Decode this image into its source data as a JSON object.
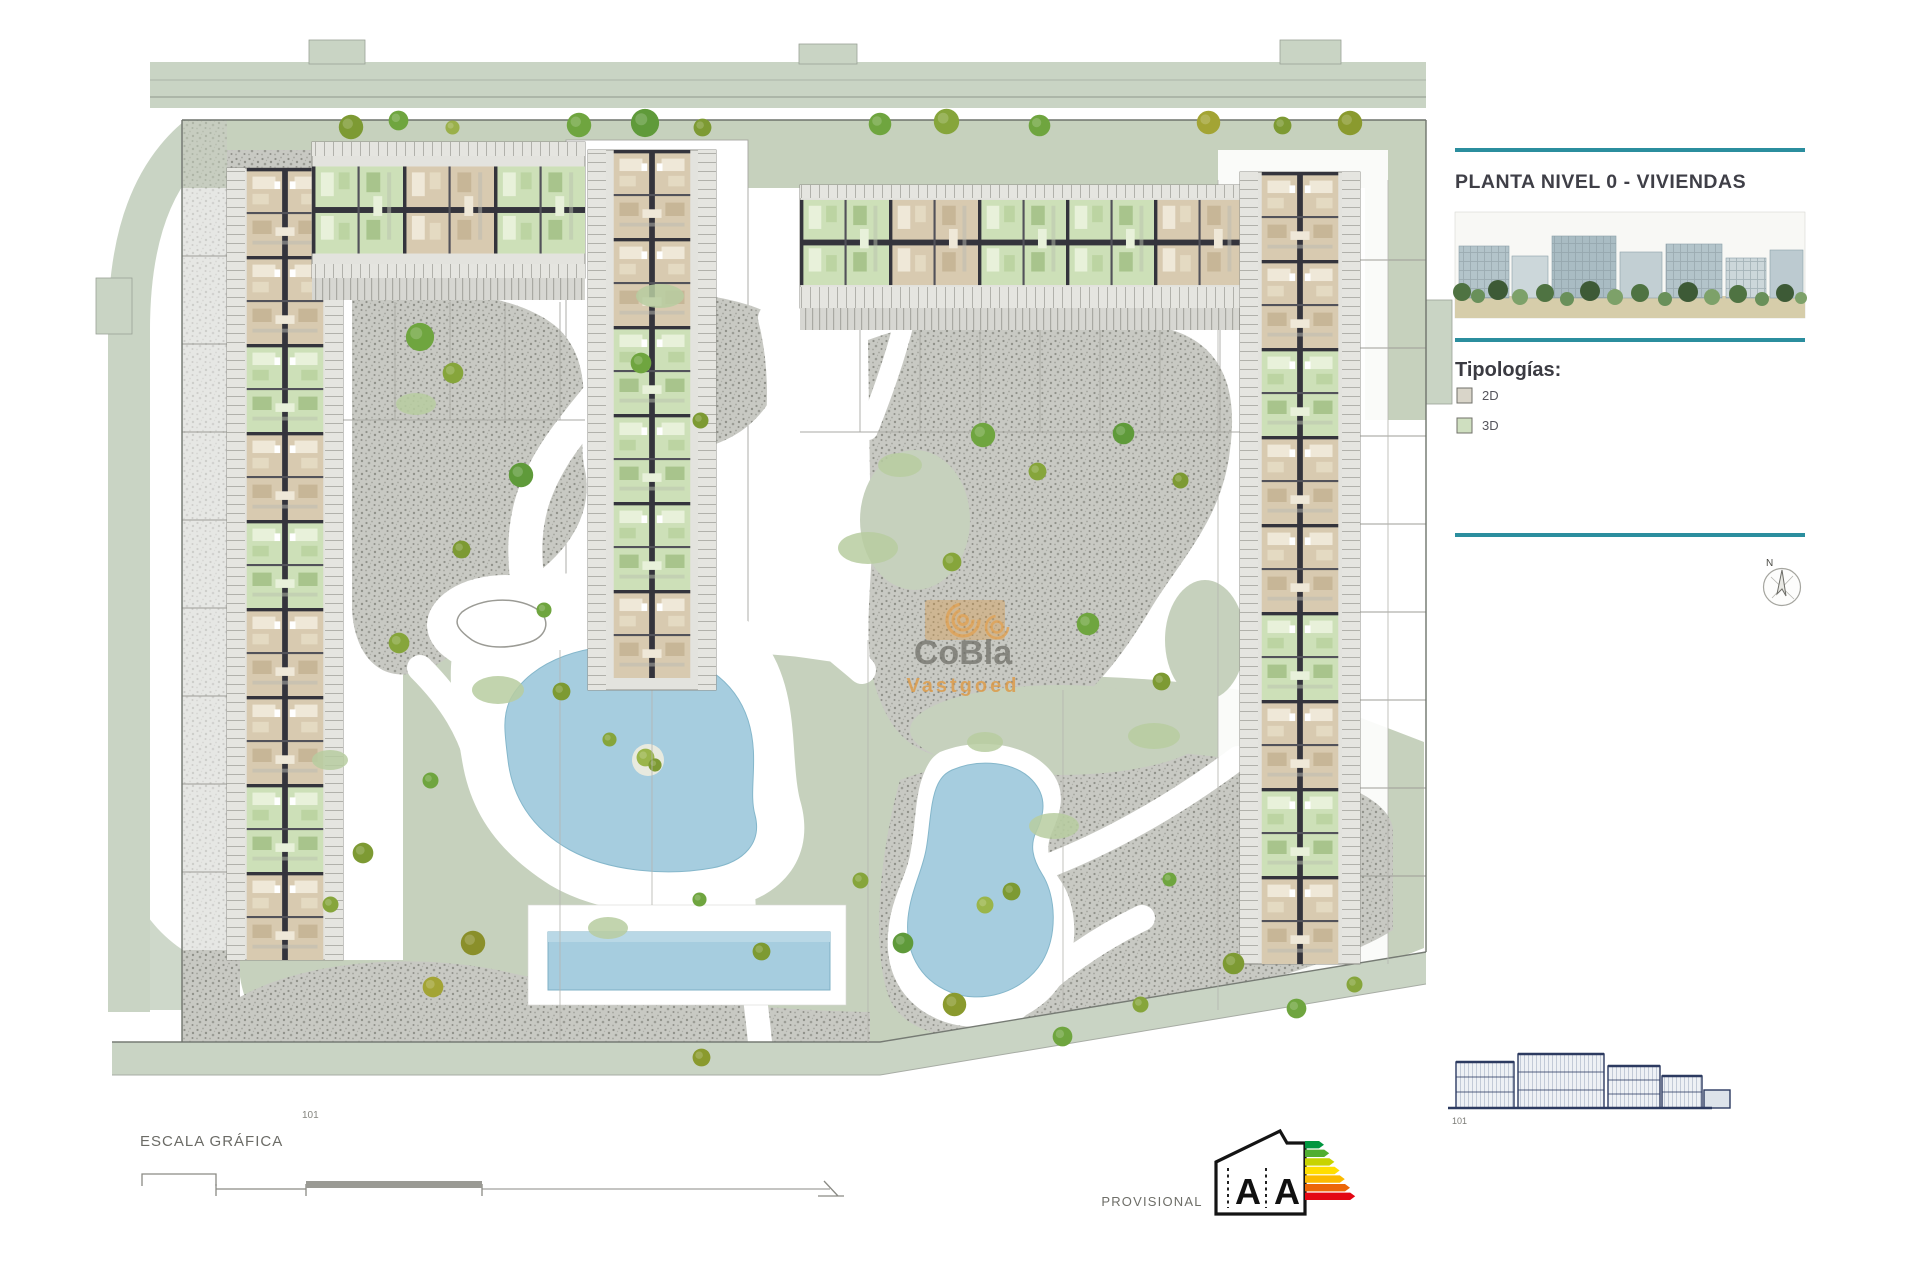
{
  "panel": {
    "title": "PLANTA NIVEL 0 - VIVIENDAS",
    "typologies_heading": "Tipologías:",
    "legend": [
      {
        "label": "2D",
        "color": "#d9d5c9"
      },
      {
        "label": "3D",
        "color": "#cfdfc0"
      }
    ],
    "accent_color": "#2b8e9e",
    "compass_label": "N"
  },
  "plan": {
    "watermark_line1": "CoBla",
    "watermark_line2": "Vastgoed",
    "ref_label": "101"
  },
  "footer": {
    "scale_label": "ESCALA GRÁFICA",
    "provisional_label": "PROVISIONAL",
    "energy": {
      "letter_left": "A",
      "letter_right": "A",
      "arrow_colors": [
        "#00963f",
        "#50ae31",
        "#c7d301",
        "#ffde00",
        "#fbba00",
        "#ec6608",
        "#e30613"
      ]
    },
    "elevation_ref": "101"
  },
  "palette": {
    "accent_teal": "#2b8e9e",
    "site_lawn": "#c6d1bd",
    "road_band": "#c9d4c4",
    "gravel": "#c8c9c3",
    "pool_water": "#a6cddf",
    "unit_tan": "#d8cab0",
    "unit_green": "#cde0b8",
    "wall_dark": "#34343c",
    "tree_olive": "#7d9a33",
    "tree_green": "#6fa53f",
    "watermark_orange": "#dd9a45",
    "elevation_blue": "#2c3a60"
  }
}
